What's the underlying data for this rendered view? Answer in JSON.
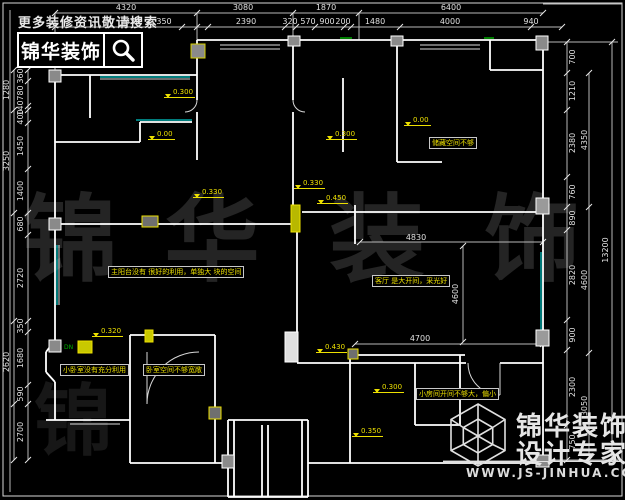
{
  "promo": {
    "search_hint": "更多装修资讯敬请搜索",
    "brand": "锦华装饰"
  },
  "watermark": {
    "chars": [
      "锦",
      "华",
      "装",
      "饰"
    ],
    "partial_char": "锦"
  },
  "footer": {
    "brand_line1": "锦华装饰",
    "brand_line2": "设计专家",
    "url": "WWW.JS-JINHUA.COM"
  },
  "dimensions": {
    "top_outer": [
      {
        "t": "4320",
        "x": 126,
        "y": 4,
        "o": "h"
      },
      {
        "t": "3080",
        "x": 243,
        "y": 4,
        "o": "h"
      },
      {
        "t": "1870",
        "x": 326,
        "y": 4,
        "o": "h"
      },
      {
        "t": "6400",
        "x": 451,
        "y": 4,
        "o": "h"
      }
    ],
    "top_inner": [
      {
        "t": "450",
        "x": 133,
        "y": 18,
        "o": "h"
      },
      {
        "t": "350",
        "x": 164,
        "y": 18,
        "o": "h"
      },
      {
        "t": "2390",
        "x": 246,
        "y": 18,
        "o": "h"
      },
      {
        "t": "320",
        "x": 290,
        "y": 18,
        "o": "h"
      },
      {
        "t": "570",
        "x": 308,
        "y": 18,
        "o": "h"
      },
      {
        "t": "900",
        "x": 327,
        "y": 18,
        "o": "h"
      },
      {
        "t": "200",
        "x": 343,
        "y": 18,
        "o": "h"
      },
      {
        "t": "1480",
        "x": 375,
        "y": 18,
        "o": "h"
      },
      {
        "t": "4000",
        "x": 450,
        "y": 18,
        "o": "h"
      },
      {
        "t": "940",
        "x": 531,
        "y": 18,
        "o": "h"
      }
    ],
    "left_outer": [
      {
        "t": "1280",
        "x": 7,
        "y": 90,
        "o": "v"
      },
      {
        "t": "3250",
        "x": 7,
        "y": 161,
        "o": "v"
      },
      {
        "t": "2620",
        "x": 7,
        "y": 362,
        "o": "v"
      }
    ],
    "left_inner": [
      {
        "t": "360",
        "x": 21,
        "y": 76,
        "o": "v"
      },
      {
        "t": "780",
        "x": 21,
        "y": 93,
        "o": "v"
      },
      {
        "t": "140",
        "x": 21,
        "y": 108,
        "o": "v"
      },
      {
        "t": "400",
        "x": 21,
        "y": 117,
        "o": "v"
      },
      {
        "t": "1450",
        "x": 21,
        "y": 146,
        "o": "v"
      },
      {
        "t": "1400",
        "x": 21,
        "y": 191,
        "o": "v"
      },
      {
        "t": "680",
        "x": 21,
        "y": 224,
        "o": "v"
      },
      {
        "t": "2720",
        "x": 21,
        "y": 278,
        "o": "v"
      },
      {
        "t": "350",
        "x": 21,
        "y": 326,
        "o": "v"
      },
      {
        "t": "1680",
        "x": 21,
        "y": 358,
        "o": "v"
      },
      {
        "t": "590",
        "x": 21,
        "y": 394,
        "o": "v"
      },
      {
        "t": "2700",
        "x": 21,
        "y": 432,
        "o": "v"
      }
    ],
    "right_inner": [
      {
        "t": "700",
        "x": 573,
        "y": 57,
        "o": "v"
      },
      {
        "t": "1210",
        "x": 573,
        "y": 91,
        "o": "v"
      },
      {
        "t": "2380",
        "x": 573,
        "y": 143,
        "o": "v"
      },
      {
        "t": "760",
        "x": 573,
        "y": 192,
        "o": "v"
      },
      {
        "t": "890",
        "x": 573,
        "y": 218,
        "o": "v"
      },
      {
        "t": "2820",
        "x": 573,
        "y": 275,
        "o": "v"
      },
      {
        "t": "900",
        "x": 573,
        "y": 335,
        "o": "v"
      },
      {
        "t": "2300",
        "x": 573,
        "y": 387,
        "o": "v"
      },
      {
        "t": "750",
        "x": 573,
        "y": 442,
        "o": "v"
      }
    ],
    "right_mid": [
      {
        "t": "4350",
        "x": 585,
        "y": 140,
        "o": "v"
      },
      {
        "t": "4600",
        "x": 585,
        "y": 280,
        "o": "v"
      },
      {
        "t": "3050",
        "x": 585,
        "y": 406,
        "o": "v"
      }
    ],
    "right_total": [
      {
        "t": "13200",
        "x": 606,
        "y": 250,
        "o": "v"
      }
    ],
    "interior": [
      {
        "t": "4830",
        "x": 416,
        "y": 234,
        "o": "h"
      },
      {
        "t": "4700",
        "x": 420,
        "y": 335,
        "o": "h"
      },
      {
        "t": "4600",
        "x": 456,
        "y": 294,
        "o": "v"
      }
    ]
  },
  "levels": [
    {
      "t": "0.300",
      "x": 164,
      "y": 89
    },
    {
      "t": "0.00",
      "x": 148,
      "y": 131
    },
    {
      "t": "0.300",
      "x": 326,
      "y": 131
    },
    {
      "t": "0.00",
      "x": 404,
      "y": 117
    },
    {
      "t": "0.330",
      "x": 193,
      "y": 189
    },
    {
      "t": "0.330",
      "x": 294,
      "y": 180
    },
    {
      "t": "0.450",
      "x": 317,
      "y": 195
    },
    {
      "t": "0.320",
      "x": 92,
      "y": 328
    },
    {
      "t": "0.430",
      "x": 316,
      "y": 344
    },
    {
      "t": "0.300",
      "x": 373,
      "y": 384
    },
    {
      "t": "0.350",
      "x": 352,
      "y": 428
    }
  ],
  "annotations": [
    {
      "t": "主阳台没有 很好的利用，单独大 块的空间",
      "x": 108,
      "y": 266
    },
    {
      "t": "客厅 是大开间，采光好",
      "x": 372,
      "y": 275
    },
    {
      "t": "储藏空间不够",
      "x": 429,
      "y": 137
    },
    {
      "t": "小卧室没有充分利用",
      "x": 60,
      "y": 364
    },
    {
      "t": "卧室空间不够宽敞",
      "x": 143,
      "y": 364
    },
    {
      "t": "小房间开间不够大，偏小",
      "x": 416,
      "y": 388
    }
  ],
  "plan_marks": {
    "stair_note": "DN"
  }
}
